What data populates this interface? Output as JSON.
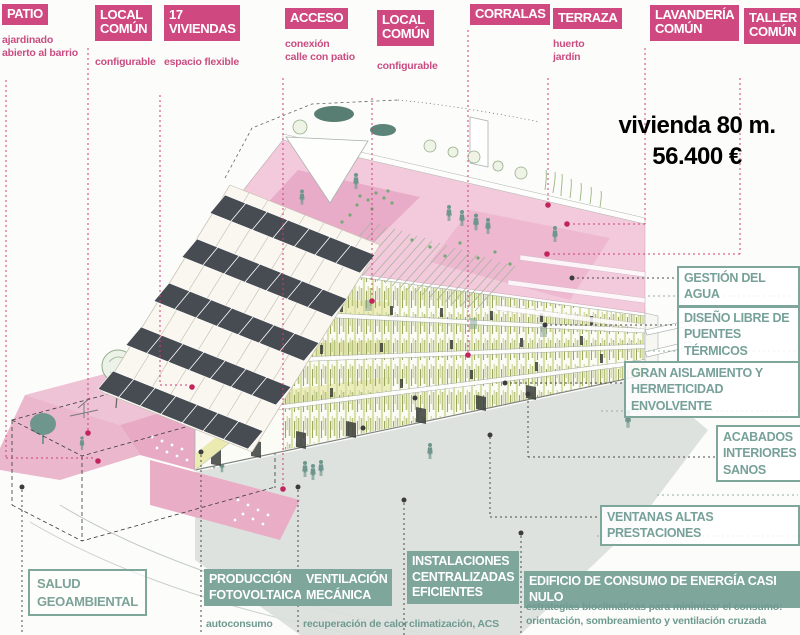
{
  "title": {
    "line1": "vivienda 80 m.",
    "line2": "56.400 €"
  },
  "top_labels": [
    {
      "title": "PATIO",
      "sub": "ajardinado\nabierto al barrio"
    },
    {
      "title": "LOCAL\nCOMÚN",
      "sub": "configurable"
    },
    {
      "title": "17\nVIVIENDAS",
      "sub": "espacio flexible"
    },
    {
      "title": "ACCESO",
      "sub": "conexión\ncalle con patio"
    },
    {
      "title": "LOCAL\nCOMÚN",
      "sub": "configurable"
    },
    {
      "title": "CORRALAS",
      "sub": ""
    },
    {
      "title": "TERRAZA",
      "sub": "huerto\njardín"
    },
    {
      "title": "LAVANDERÍA\nCOMÚN",
      "sub": ""
    },
    {
      "title": "TALLER\nCOMÚN",
      "sub": ""
    }
  ],
  "right_labels": [
    {
      "title": "GESTIÓN DEL AGUA"
    },
    {
      "title": "DISEÑO LIBRE DE\nPUENTES TÉRMICOS"
    },
    {
      "title": "GRAN AISLAMIENTO Y\nHERMETICIDAD ENVOLVENTE"
    },
    {
      "title": "ACABADOS\nINTERIORES\nSANOS"
    },
    {
      "title": "VENTANAS ALTAS PRESTACIONES"
    }
  ],
  "bottom_labels": [
    {
      "title": "SALUD\nGEOAMBIENTAL",
      "sub": ""
    },
    {
      "title": "PRODUCCIÓN\nFOTOVOLTAICA",
      "sub": "autoconsumo"
    },
    {
      "title": "VENTILACIÓN\nMECÁNICA",
      "sub": "recuperación de calor"
    },
    {
      "title": "INSTALACIONES\nCENTRALIZADAS\nEFICIENTES",
      "sub": "climatización, ACS"
    },
    {
      "title": "EDIFICIO DE CONSUMO DE ENERGÍA CASI NULO",
      "sub": "estrategias bioclimáticas para minimizar el consumo:\norientación, sombreamiento y ventilación cruzada"
    }
  ],
  "colors": {
    "pink_label": "#cf4980",
    "pink_text": "#c94d82",
    "teal_solid": "#7ea69b",
    "teal_text": "#77a198",
    "roof_pink": "#f3cadb",
    "patio_pink": "#e7a9c4",
    "solar_panel": "#474c52",
    "shadow": "#dadfdb",
    "figure_teal": "#6f968c"
  }
}
